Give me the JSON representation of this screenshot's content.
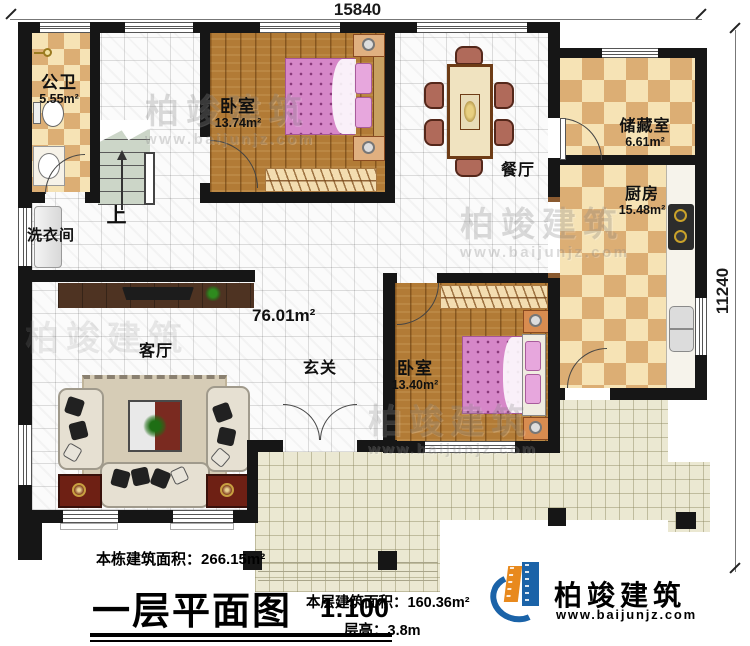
{
  "plan": {
    "dimension_top": "15840",
    "dimension_right": "11240",
    "rooms": {
      "bathroom": {
        "name": "公卫",
        "area": "5.55m²"
      },
      "laundry": {
        "name": "洗衣间"
      },
      "stairs": {
        "up_label": "上"
      },
      "bedroom1": {
        "name": "卧室",
        "area": "13.74m²"
      },
      "dining": {
        "name": "餐厅"
      },
      "storage": {
        "name": "储藏室",
        "area": "6.61m²"
      },
      "kitchen": {
        "name": "厨房",
        "area": "15.48m²"
      },
      "living": {
        "name": "客厅"
      },
      "foyer": {
        "name": "玄关"
      },
      "bedroom2": {
        "name": "卧室",
        "area": "13.40m²"
      },
      "open_area": {
        "area": "76.01m²"
      }
    }
  },
  "footer": {
    "building_area_label": "本栋建筑面积：",
    "building_area_value": "266.15m²",
    "plan_title": "一层平面图",
    "plan_scale": "1:100",
    "floor_area_label": "本层建筑面积：",
    "floor_area_value": "160.36m²",
    "floor_height_label": "层高：",
    "floor_height_value": "3.8m"
  },
  "branding": {
    "company": "柏竣建筑",
    "website": "www.baijunjz.com"
  },
  "watermark": {
    "company": "柏竣建筑",
    "website": "www.baijunjz.com"
  },
  "colors": {
    "wall": "#161616",
    "logo_blue": "#1b63a8",
    "logo_orange": "#e8891d",
    "wood_floor": "#b27b36",
    "checker_dark": "#dcae74",
    "checker_light": "#f6e3b5",
    "terrace": "#ebe8d2",
    "bed_pink": "#d687c8"
  }
}
